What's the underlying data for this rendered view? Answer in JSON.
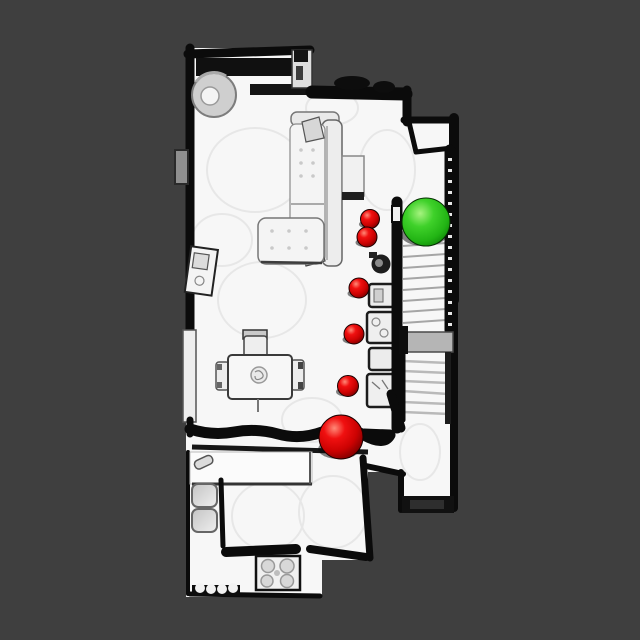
{
  "scene": {
    "background_color": "#3f3f3f",
    "floor_color": "#f7f7f7",
    "wall_color": "#0b0b0b",
    "stair_landing_color": "#b5b5b5",
    "kind": "top-down-house-scan-with-navigation-markers"
  },
  "markers": {
    "goal": {
      "x": 426,
      "y": 222,
      "r": 24,
      "core_color": "#3fd12a",
      "highlight_color": "#a6f37f",
      "edge_color": "#0b7d05"
    },
    "waypoint_core_color": "#f01010",
    "waypoint_highlight_color": "#ff8a78",
    "waypoint_edge_color": "#6f0000",
    "waypoints": [
      {
        "x": 370,
        "y": 219,
        "r": 9.5
      },
      {
        "x": 367,
        "y": 237,
        "r": 10
      },
      {
        "x": 359,
        "y": 288,
        "r": 10
      },
      {
        "x": 354,
        "y": 334,
        "r": 10
      },
      {
        "x": 348,
        "y": 386,
        "r": 10.5
      },
      {
        "x": 341,
        "y": 437,
        "r": 22
      }
    ]
  }
}
